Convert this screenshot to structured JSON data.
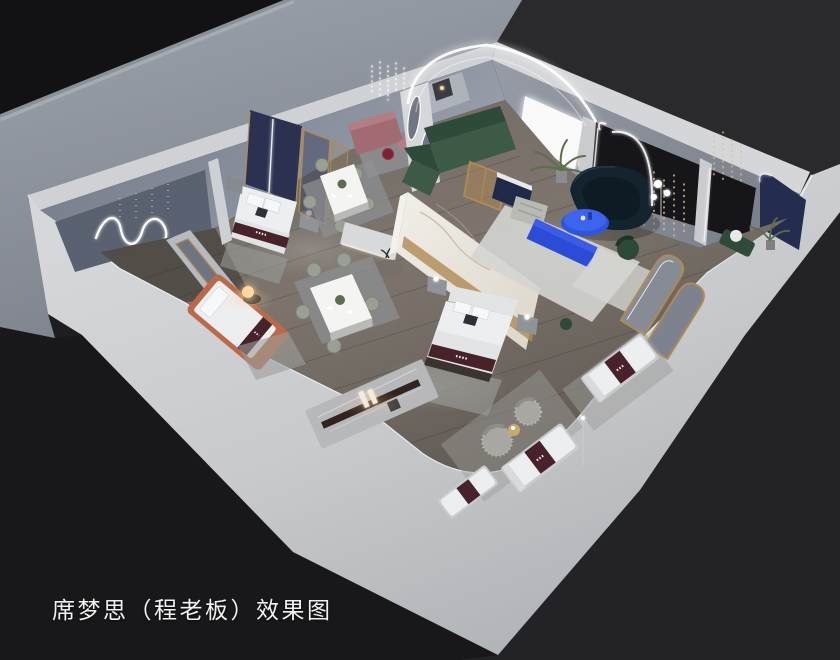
{
  "caption": {
    "text": "席梦思（程老板）效果图"
  },
  "colors": {
    "bg": "#1e1e21",
    "bg_topleft": "#121214",
    "bg_topright": "#2a2a2d",
    "bg_bottomright": "#232327",
    "bg_bottomleft": "#18181b",
    "backdrop_slab_top": "#9aa0a9",
    "backdrop_slab_bottom": "#7d828d",
    "slab_bevel": "#aab0b8",
    "wall_band_light": "#d6d7da",
    "wall_band_mid": "#c6c8cb",
    "wall_band_dark": "#aeb1b5",
    "wall_top_edge": "#ecedef",
    "wall_nw": "#868c99",
    "wall_nw_deep": "#747a87",
    "wall_panel_dark": "#5a6170",
    "wall_ne": "#8b9099",
    "niche_dark": "#16161a",
    "navy_panel": "#242d50",
    "headboard_navy": "#2b3150",
    "floor_light": "#7d756d",
    "floor_dark": "#5e5751",
    "plank_line": "#3f3a35",
    "rug_gray": "#9d9e9a",
    "rug_light": "#d4d5d1",
    "rug_blue_gray": "#8e9195",
    "marble_light": "#f1efe9",
    "marble_dark": "#dcd6c9",
    "marble_vein": "#c5b193",
    "gold": "#b08a54",
    "bed_white": "#edeeef",
    "bed_shade": "#dcdee1",
    "runner_maroon": "#48222a",
    "orange_bed": "#b96a4a",
    "mauve": "#a26b73",
    "mauve_light": "#b37d84",
    "red_glass": "#7c2230",
    "sofa_green_dark": "#2e4a38",
    "sofa_green": "#3c5a45",
    "sofa_navy_teal": "#14242e",
    "cobalt_blue": "#2f55e0",
    "cobalt_blue_light": "#3d64ec",
    "cobalt_bench": "#2a4cd6",
    "media_navy": "#1e2a48",
    "nightstand_gray": "#8f9499",
    "chair_green_gray": "#99a093",
    "plant_green": "#5c6e4b",
    "fuzzy_gray": "#a8a7a2",
    "stone_platform": "#b7b8ba",
    "rail_brown": "#33231e",
    "sparkle_gold": "#e3c086",
    "led_white": "#ffffff",
    "warm_glow": "#ffd9a0",
    "caption": "#f2f2f2"
  }
}
